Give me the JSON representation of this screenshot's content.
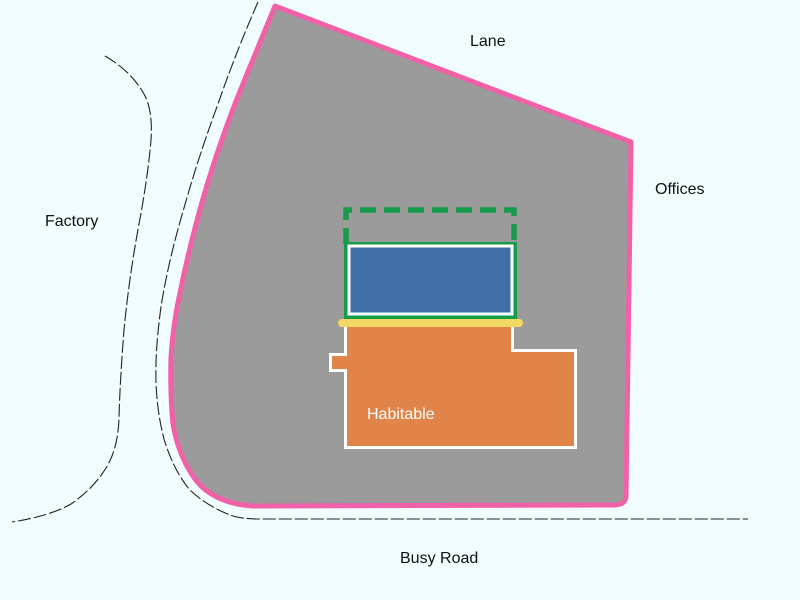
{
  "diagram": {
    "type": "site-plan",
    "labels": {
      "lane": "Lane",
      "offices": "Offices",
      "factory": "Factory",
      "busy_road": "Busy Road",
      "habitable": "Habitable"
    },
    "colors": {
      "background": "#f0fcfd",
      "site_fill": "#9b9b9b",
      "boundary_pink": "#f161a8",
      "proposed_green": "#159b49",
      "building_blue": "#4170a8",
      "strip_yellow": "#f2d964",
      "habitable_orange": "#e08449",
      "building_border_white": "#ffffff",
      "road_line": "#222222",
      "label_text": "#111111",
      "habitable_text": "#ffffff"
    }
  }
}
